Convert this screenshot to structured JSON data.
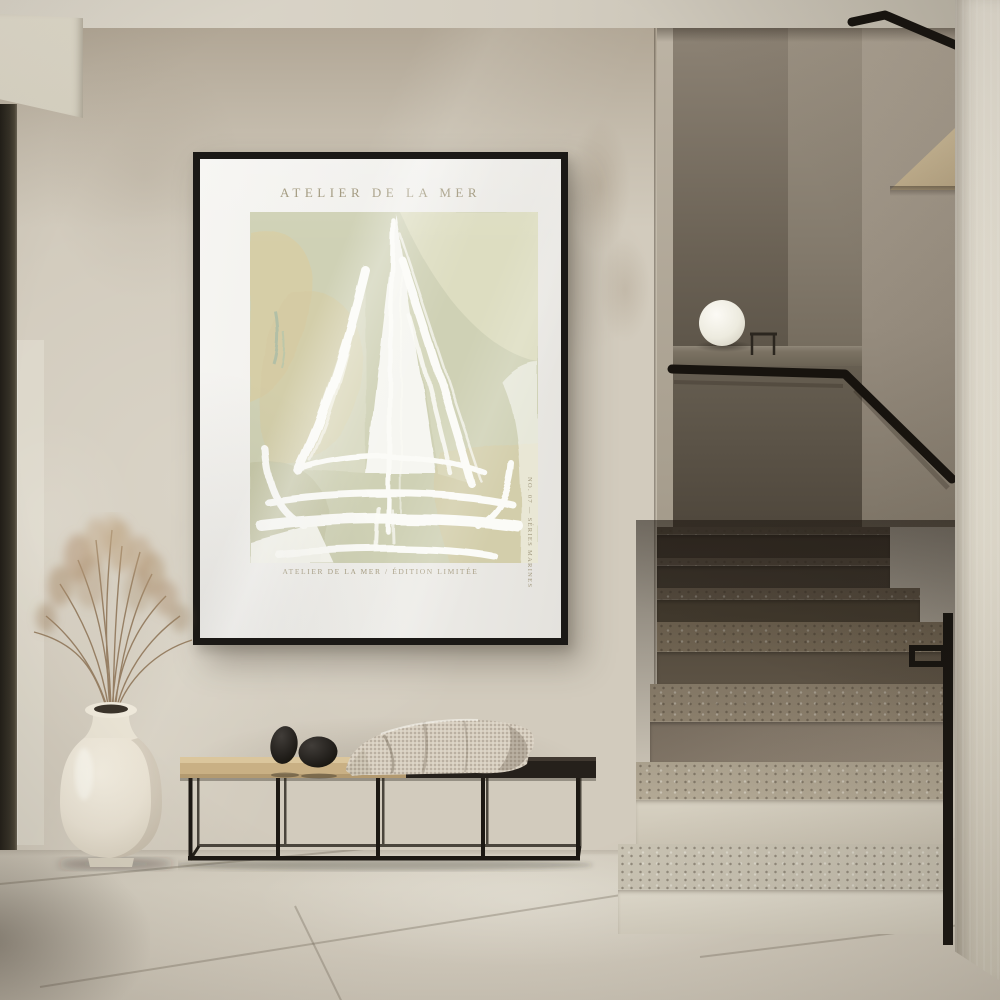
{
  "poster": {
    "title": "ATELIER DE LA MER",
    "caption": "ATELIER DE LA MER / ÉDITION LIMITÉE",
    "edition_note": "NO. 07 — SÉRIES MARINES"
  },
  "scene": {
    "description": "Minimalist japandi hallway with framed sailboat art print, bench with knit throw and stone objects, dried grass in a cream vase, sphere lamp on stair parapet, terrazzo staircase with black metal handrail",
    "objects": [
      "framed-art-print",
      "dried-grass-vase",
      "metal-frame-bench",
      "knit-throw-blanket",
      "stone-objects",
      "sphere-lamp",
      "terrazzo-staircase",
      "black-handrail"
    ]
  },
  "palette": {
    "wall": "#d2cbbd",
    "ceiling": "#d8d3c7",
    "door_frame": "#343026",
    "frame": "#1b1916",
    "poster_mat": "#f2f1ee",
    "art_sage": "#cfd1b5",
    "art_beige": "#d6cba3",
    "art_white": "#fbfbf7",
    "title_ink": "#9d9478",
    "bench_wood": "#c9b084",
    "bench_dark": "#25201b",
    "bench_metal": "#1c1813",
    "blanket": "#d6cdbe",
    "stone": "#1f1c19",
    "vase": "#eae3d4",
    "grass": "#b49877",
    "stairs_shadowed": "#6c6152",
    "stairs_light": "#ddd8ca",
    "rail": "#16130f",
    "right_wall": "#e8e3d6",
    "floor": "#d3ccbe",
    "lamp": "#f4f1ea"
  }
}
